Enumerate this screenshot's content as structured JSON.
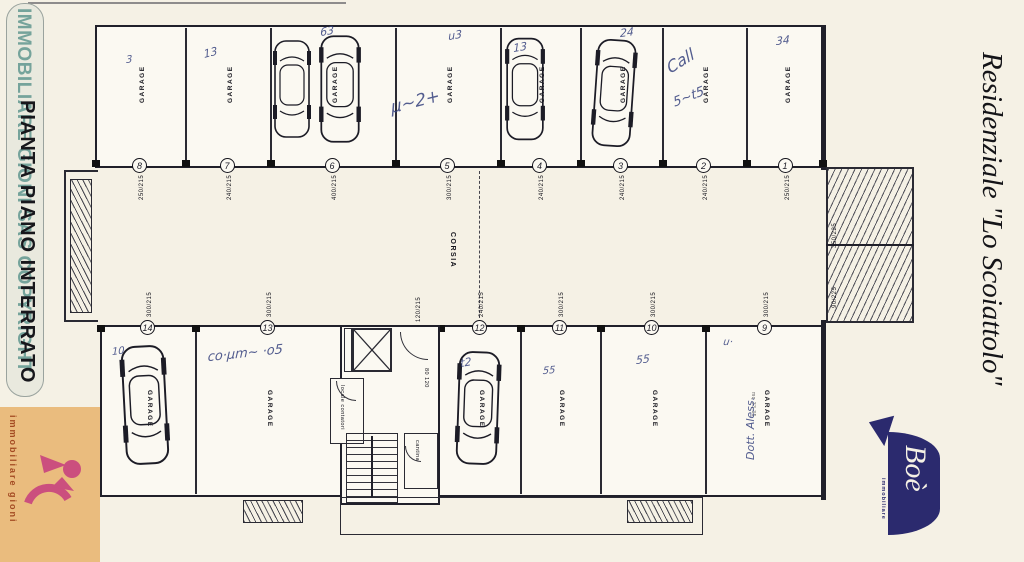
{
  "watermark": {
    "teal_text": "IMMOBILIARE GIONI SAS COPYRIGHT",
    "black_text": "PIANTA PIANO INTERRATO"
  },
  "side_title": "Residenziale \"Lo Scoiattolo\"",
  "logo_gioni": {
    "name": "immobiliare gioni"
  },
  "logo_boe": {
    "script": "Boè",
    "sub": "immobiliare"
  },
  "plan": {
    "corridor_label": "CORSIA",
    "garage_label": "GARAGE",
    "top_row": [
      {
        "num": "8",
        "dim": "250/215",
        "cars": 0
      },
      {
        "num": "7",
        "dim": "240/215",
        "cars": 0
      },
      {
        "num": "6",
        "dim": "400/215",
        "cars": 2
      },
      {
        "num": "5",
        "dim": "300/215",
        "cars": 0
      },
      {
        "num": "4",
        "dim": "240/215",
        "cars": 1
      },
      {
        "num": "3",
        "dim": "240/215",
        "cars": 1
      },
      {
        "num": "2",
        "dim": "240/215",
        "cars": 0
      },
      {
        "num": "1",
        "dim": "250/215",
        "cars": 0
      }
    ],
    "bottom_row": [
      {
        "num": "14",
        "dim": "300/215",
        "cars": 1
      },
      {
        "num": "13",
        "dim": "300/215",
        "cars": 0
      },
      {
        "num": "12",
        "dim": "240/215",
        "cars": 1
      },
      {
        "num": "11",
        "dim": "300/215",
        "cars": 0
      },
      {
        "num": "10",
        "dim": "300/215",
        "cars": 0
      },
      {
        "num": "9",
        "dim": "300/215",
        "cars": 0
      }
    ],
    "core": {
      "meters_room": "locale contatori",
      "cellar": "cantina",
      "inner_door_dim": "80 120",
      "corridor_door_dim": "120/215"
    },
    "ramp_dims": [
      "350/225",
      "90/225"
    ],
    "garage9_area": "mq 33.35",
    "annotations": [
      "3",
      "13",
      "63",
      "u3",
      "µ~2+",
      "13",
      "24",
      "Call",
      "5~t5",
      "34",
      "10",
      "co·µm~ ·o5",
      "t2",
      "55",
      "55",
      "u·",
      "Dott. Aless."
    ]
  }
}
